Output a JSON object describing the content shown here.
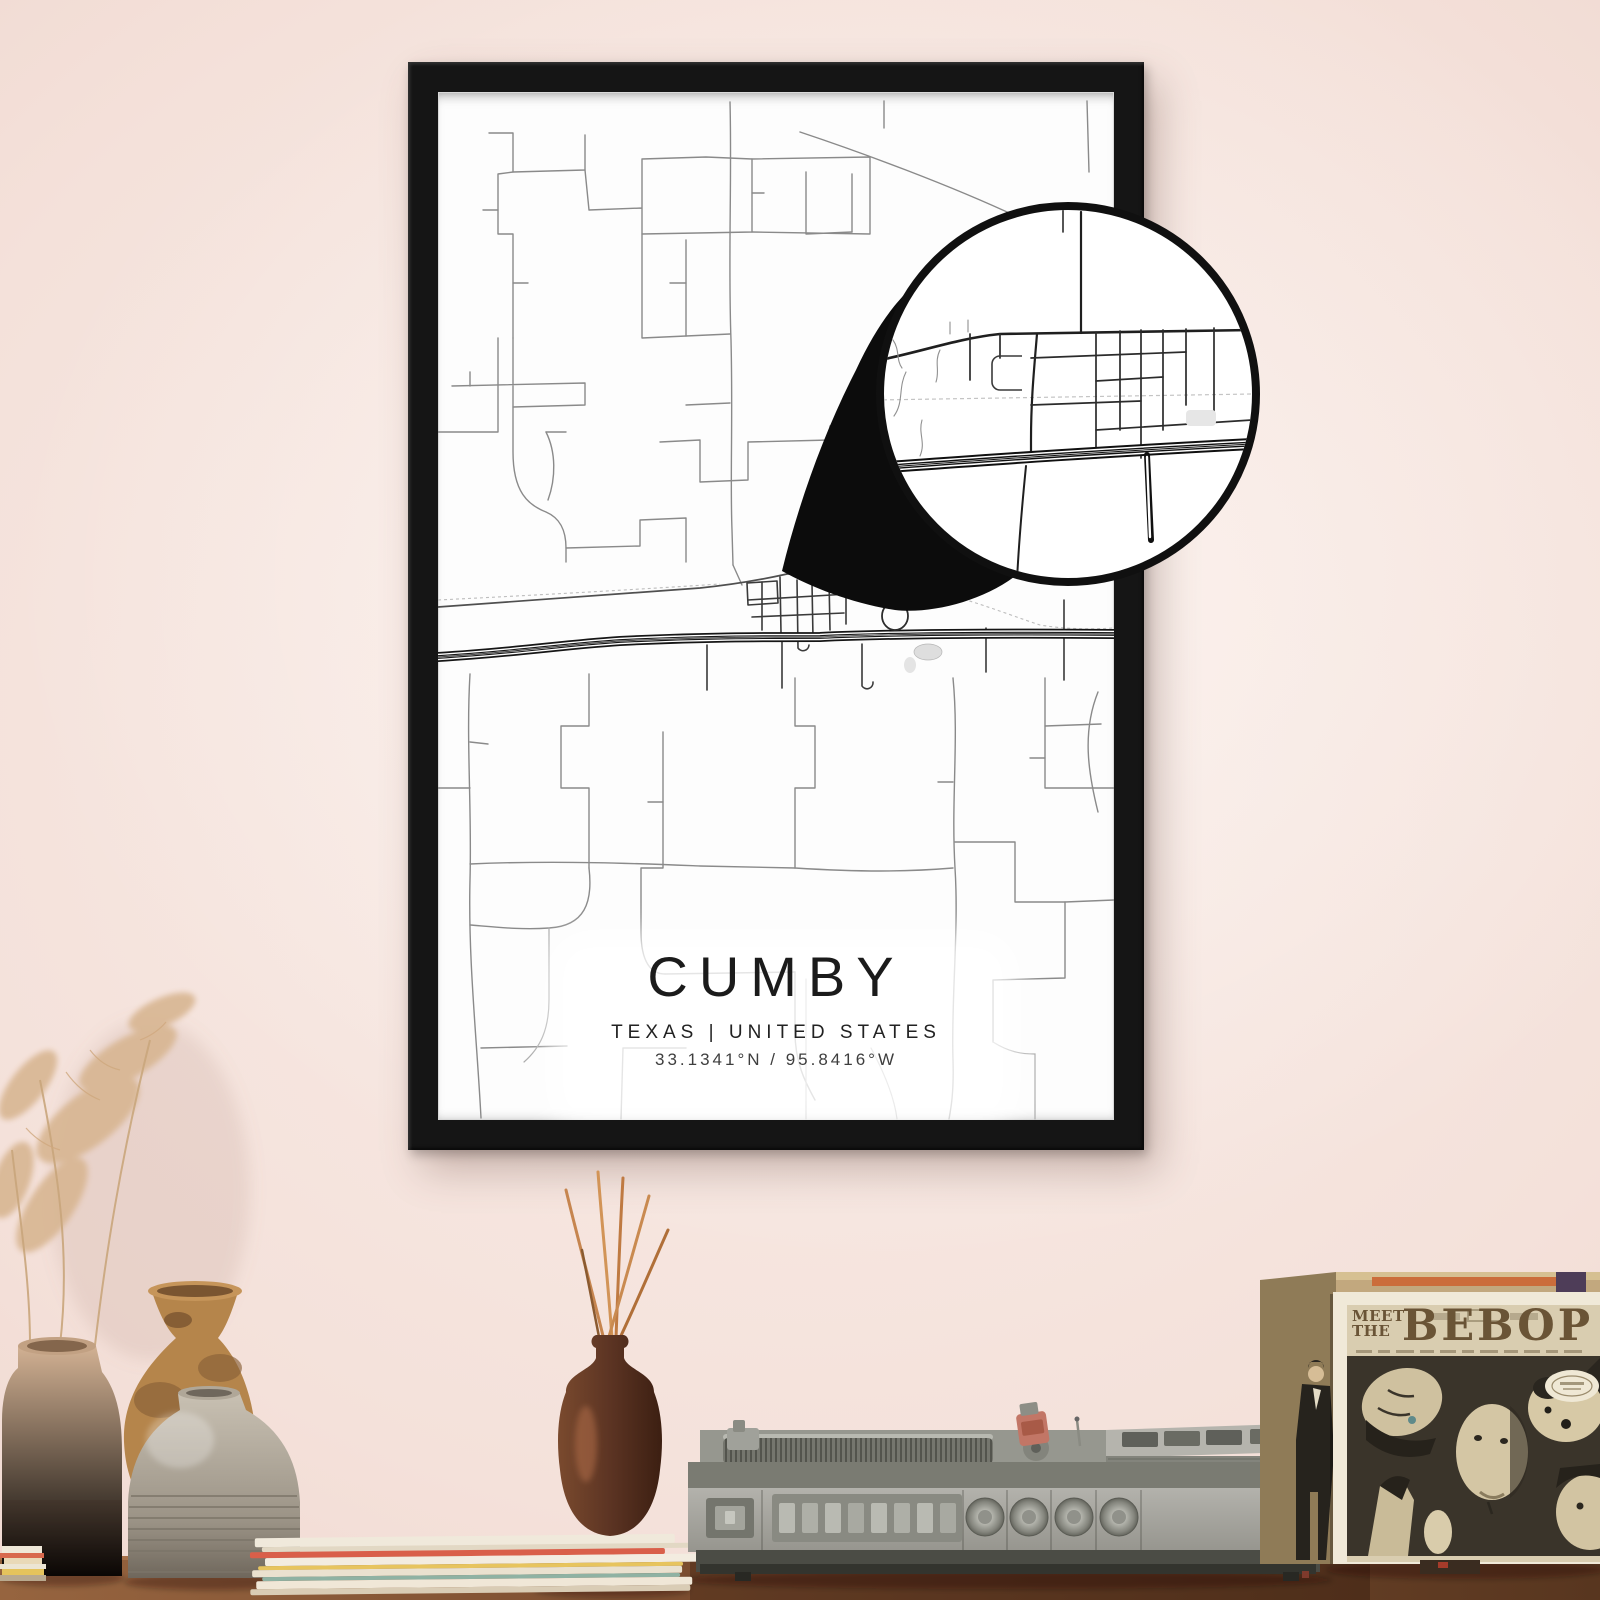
{
  "poster": {
    "title": "CUMBY",
    "subtitle": "TEXAS | UNITED STATES",
    "coordinates": "33.1341°N / 95.8416°W"
  },
  "record_sleeve": {
    "meet": "MEET",
    "the": "THE",
    "title": "BEBOP"
  },
  "colors": {
    "wall": "#f2ded7",
    "frame": "#151515",
    "paper": "#fdfdfd",
    "minor_road": "#8a8a8a",
    "highway": "#161616",
    "wood": "#7a4c2f",
    "sleeve_title": "#6a5436",
    "accent_orange": "#cb6d3b"
  }
}
